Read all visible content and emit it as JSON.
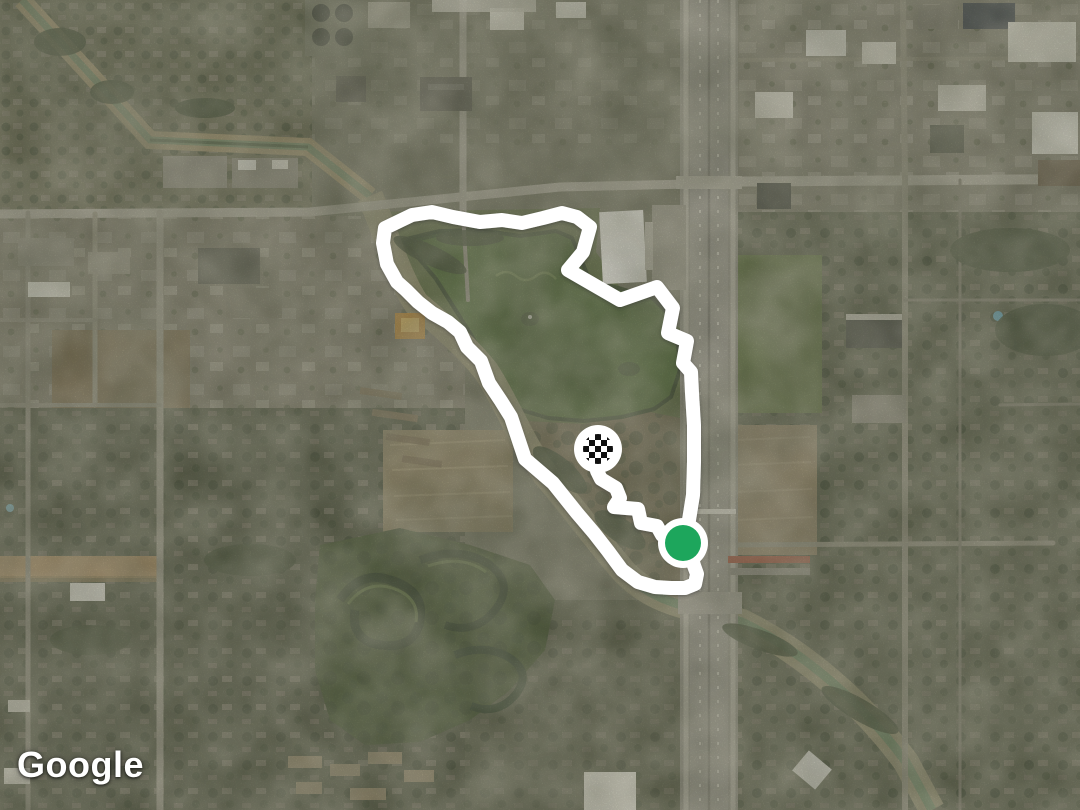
{
  "map": {
    "attribution": "Google",
    "route": {
      "color": "#ffffff",
      "stroke_width": 14,
      "loop_points": [
        [
          385,
          228
        ],
        [
          412,
          215
        ],
        [
          432,
          212
        ],
        [
          453,
          217
        ],
        [
          480,
          222
        ],
        [
          502,
          220
        ],
        [
          522,
          223
        ],
        [
          543,
          218
        ],
        [
          562,
          213
        ],
        [
          577,
          217
        ],
        [
          590,
          227
        ],
        [
          583,
          252
        ],
        [
          568,
          270
        ],
        [
          620,
          300
        ],
        [
          657,
          287
        ],
        [
          673,
          308
        ],
        [
          668,
          333
        ],
        [
          687,
          341
        ],
        [
          683,
          363
        ],
        [
          691,
          372
        ],
        [
          692,
          393
        ],
        [
          694,
          425
        ],
        [
          694,
          462
        ],
        [
          693,
          495
        ],
        [
          689,
          520
        ],
        [
          683,
          543
        ],
        [
          692,
          560
        ],
        [
          697,
          574
        ],
        [
          695,
          584
        ],
        [
          685,
          588
        ],
        [
          671,
          588
        ],
        [
          655,
          587
        ],
        [
          638,
          582
        ],
        [
          622,
          570
        ],
        [
          608,
          551
        ],
        [
          594,
          533
        ],
        [
          577,
          513
        ],
        [
          553,
          483
        ],
        [
          525,
          459
        ],
        [
          518,
          438
        ],
        [
          511,
          417
        ],
        [
          501,
          401
        ],
        [
          489,
          383
        ],
        [
          481,
          361
        ],
        [
          467,
          347
        ],
        [
          460,
          332
        ],
        [
          448,
          322
        ],
        [
          432,
          313
        ],
        [
          418,
          302
        ],
        [
          406,
          290
        ],
        [
          397,
          282
        ],
        [
          387,
          264
        ],
        [
          383,
          243
        ],
        [
          385,
          228
        ]
      ],
      "finish_points": [
        [
          676,
          539
        ],
        [
          662,
          535
        ],
        [
          657,
          526
        ],
        [
          641,
          523
        ],
        [
          638,
          509
        ],
        [
          614,
          507
        ],
        [
          620,
          498
        ],
        [
          616,
          488
        ],
        [
          601,
          479
        ],
        [
          597,
          471
        ],
        [
          598,
          459
        ],
        [
          598,
          449
        ]
      ]
    },
    "markers": {
      "start": {
        "x": 683,
        "y": 543,
        "dot_radius": 18,
        "dot_color": "#1da65c",
        "ring_color": "#ffffff",
        "ring_outer_radius": 25
      },
      "finish": {
        "x": 598,
        "y": 449,
        "disc_radius": 24,
        "disc_color": "#ffffff",
        "checker_radius": 15,
        "checker_square": 6,
        "checker_dark": "#101010",
        "checker_light": "#ffffff"
      }
    }
  }
}
